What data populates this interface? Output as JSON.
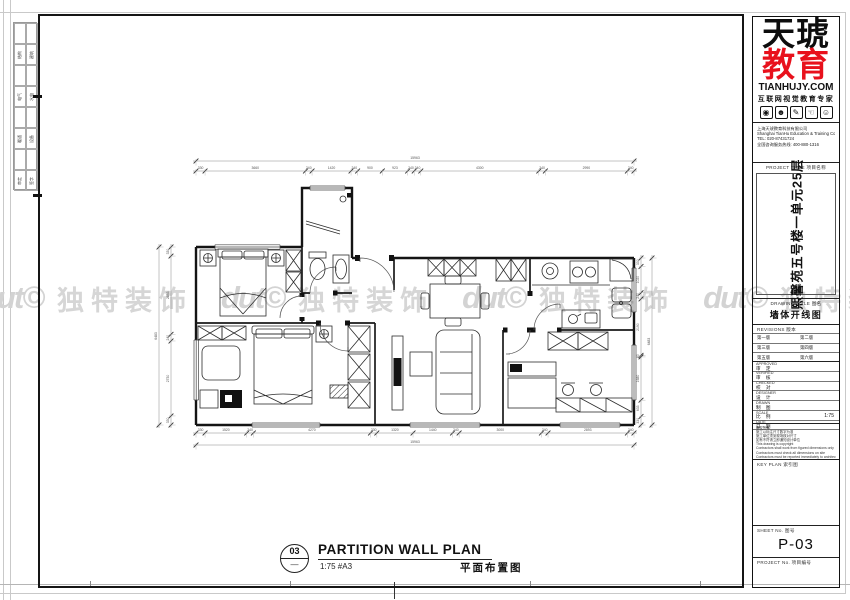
{
  "watermark": {
    "logo": "dut©",
    "text": "独特装饰",
    "repeats": 4,
    "color": "#d6d6d6"
  },
  "signoff": {
    "rows": [
      [
        "结构",
        "建筑"
      ],
      [
        "电气",
        "水电"
      ],
      [
        "暖通",
        "设备"
      ],
      [
        "审定",
        "签字"
      ]
    ]
  },
  "titleblock": {
    "brand": {
      "line1": "天琥",
      "line2": "教育",
      "line2_color": "#e8111c",
      "site": "TIANHUJY.COM",
      "tagline": "互联网视觉教育专家",
      "icon_glyphs": [
        "◉",
        "☻",
        "✎",
        "☜",
        "☺"
      ]
    },
    "company": {
      "lines": [
        "上海天琥教育科技有限公司",
        "Shanghai TianHu Education & Training Co.,Ltd.",
        "TEL: 020-87431724",
        "全国咨询服务热线: 400-880-1316"
      ]
    },
    "project_title": {
      "label": "PROJECT TITLE 项目名称",
      "value": "熙馨苑五号楼一单元25层"
    },
    "drawing_title": {
      "label": "DRAWING TITLE 图名",
      "value": "墙体开线图"
    },
    "revisions": {
      "label": "REVISIONS 版本",
      "rows": [
        [
          "第一版",
          "第二版"
        ],
        [
          "第三版",
          "第四版"
        ],
        [
          "第五版",
          "第六版"
        ]
      ]
    },
    "fields": [
      {
        "en": "APPROVED",
        "zh": "审 定",
        "value": ""
      },
      {
        "en": "VERIFIED",
        "zh": "审 核",
        "value": ""
      },
      {
        "en": "CHECKED",
        "zh": "校 对",
        "value": ""
      },
      {
        "en": "DESIGNER",
        "zh": "设 计",
        "value": ""
      },
      {
        "en": "DRAWN",
        "zh": "制 图",
        "value": ""
      },
      {
        "en": "SCALE",
        "zh": "比 例",
        "value": "1:75"
      },
      {
        "en": "DATE",
        "zh": "日 期",
        "value": ""
      }
    ],
    "notes": [
      "版权所有",
      "施工以标注尺寸数字为准",
      "施工单位须到现场核对尺寸",
      "如有不符请立即通知设计单位",
      "This drawing is copyright",
      "Contractors shall work from figured dimensions only",
      "Contractors must check all dimensions on site",
      "Contractors must be reported immediately to architects"
    ],
    "key_plan": {
      "label": "KEY PLAN 索引图"
    },
    "sheet_no": {
      "label": "SHEET No. 图号",
      "value": "P-03"
    },
    "project_no": {
      "label": "PROJECT No. 项目编号",
      "value": ""
    }
  },
  "plan_title": {
    "number": "03",
    "denominator": "—",
    "title": "PARTITION WALL PLAN",
    "scale": "1:75  #A3",
    "subtitle": "平面布置图"
  },
  "dimensions": {
    "top": {
      "overall": "15963",
      "segments": [
        "330",
        "3660",
        "240",
        "1420",
        "240",
        "900",
        "923",
        "240",
        "240",
        "4300",
        "240",
        "2990",
        "240"
      ]
    },
    "bottom": {
      "overall": "15963",
      "segments": [
        "330",
        "1520",
        "240",
        "4270",
        "230",
        "1320",
        "1440",
        "240",
        "3000",
        "240",
        "2893",
        "240"
      ]
    },
    "left": {
      "overall": "6483",
      "segments": [
        "330",
        "2853",
        "240",
        "2730",
        "330"
      ]
    },
    "right": {
      "overall": "6483",
      "segments": [
        "330",
        "1020",
        "240",
        "2190",
        "60",
        "1680",
        "633",
        "330"
      ]
    }
  }
}
